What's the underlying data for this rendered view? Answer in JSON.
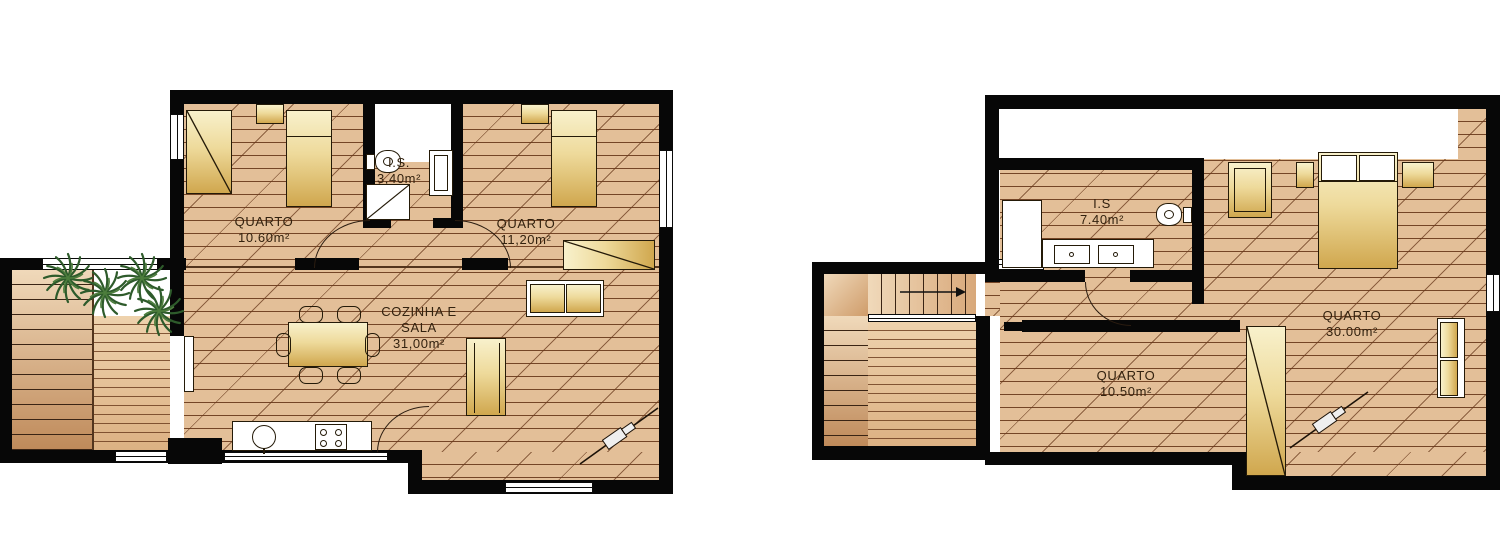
{
  "document": {
    "type": "architectural floor plan, two storeys",
    "sheet_background": "#ffffff"
  },
  "plans": [
    {
      "name": "left-floor-plan",
      "rooms": [
        {
          "name": "QUARTO",
          "area": "10.60m²"
        },
        {
          "name": "I.S.",
          "area": "3,40m²"
        },
        {
          "name": "QUARTO",
          "area": "11,20m²"
        },
        {
          "name": "COZINHA E SALA",
          "area": "31,00m²"
        }
      ]
    },
    {
      "name": "right-floor-plan",
      "rooms": [
        {
          "name": "I.S",
          "area": "7.40m²"
        },
        {
          "name": "QUARTO",
          "area": "30.00m²"
        },
        {
          "name": "QUARTO",
          "area": "10.50m²"
        }
      ]
    }
  ],
  "icons": [
    "plant-icon",
    "toilet-icon",
    "sink-icon",
    "stove-burners-icon",
    "shower-tray-icon",
    "double-sink-icon",
    "stairs-arrow-icon",
    "section-marker-icon",
    "door-swing-icon",
    "window-symbol"
  ],
  "colors": {
    "wall": "#070707",
    "floor": "#e3bf98",
    "hatch_line": "#68381a",
    "furniture_light": "#f8f1cc",
    "furniture_gold": "#d0a74e",
    "plant_green": "#2e5b2b",
    "window_white": "#ffffff"
  }
}
